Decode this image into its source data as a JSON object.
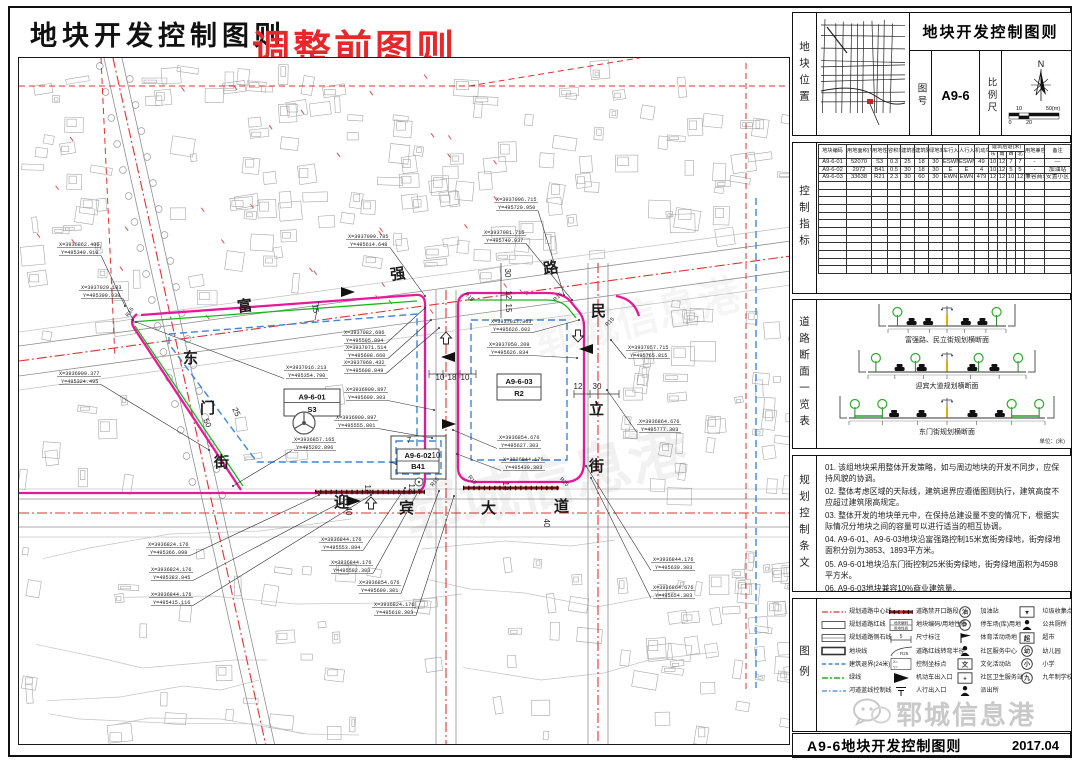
{
  "title": {
    "main": "地块开发控制图则",
    "overlay": "调整前图则"
  },
  "colors": {
    "magenta": "#e8189b",
    "green": "#18b818",
    "blue": "#3f86d8",
    "red": "#e03131",
    "overlay_red": "#e8272a"
  },
  "map": {
    "street_characters": [
      {
        "t": "富",
        "x": 219,
        "y": 254,
        "r": -8
      },
      {
        "t": "强",
        "x": 372,
        "y": 222,
        "r": -8
      },
      {
        "t": "路",
        "x": 525,
        "y": 216,
        "r": -8
      },
      {
        "t": "东",
        "x": 164,
        "y": 305,
        "r": 0
      },
      {
        "t": "门",
        "x": 181,
        "y": 355,
        "r": 0
      },
      {
        "t": "街",
        "x": 195,
        "y": 409,
        "r": 0
      },
      {
        "t": "民",
        "x": 572,
        "y": 258,
        "r": 0
      },
      {
        "t": "立",
        "x": 570,
        "y": 356,
        "r": 0
      },
      {
        "t": "街",
        "x": 570,
        "y": 413,
        "r": 0
      },
      {
        "t": "迎",
        "x": 315,
        "y": 449,
        "r": 0
      },
      {
        "t": "宾",
        "x": 380,
        "y": 455,
        "r": 0
      },
      {
        "t": "大",
        "x": 462,
        "y": 455,
        "r": 0
      },
      {
        "t": "道",
        "x": 535,
        "y": 453,
        "r": 0
      }
    ],
    "parcel_labels": [
      {
        "code": "A9-6-01",
        "use": "S3",
        "x": 265,
        "y": 331,
        "w": 56,
        "h": 27
      },
      {
        "code": "A9-6-02",
        "use": "B41",
        "x": 378,
        "y": 391,
        "w": 42,
        "h": 24
      },
      {
        "code": "A9-6-03",
        "use": "R2",
        "x": 478,
        "y": 316,
        "w": 44,
        "h": 26
      }
    ],
    "coordinate_callouts": [
      {
        "X": "X=3936862.406",
        "Y": "Y=495349.910",
        "lx": 40,
        "ly": 188,
        "ax": 106,
        "ay": 248
      },
      {
        "X": "X=3937029.103",
        "Y": "Y=495399.038",
        "lx": 62,
        "ly": 231,
        "ax": 114,
        "ay": 262
      },
      {
        "X": "X=3936999.377",
        "Y": "Y=495324.495",
        "lx": 40,
        "ly": 317,
        "ax": 190,
        "ay": 392
      },
      {
        "X": "X=3937099.785",
        "Y": "Y=495614.648",
        "lx": 329,
        "ly": 180,
        "ax": 406,
        "ay": 238
      },
      {
        "X": "X=3937082.686",
        "Y": "Y=495595.894",
        "lx": 325,
        "ly": 276,
        "ax": 406,
        "ay": 250
      },
      {
        "X": "X=3937071.514",
        "Y": "Y=495608.660",
        "lx": 327,
        "ly": 291,
        "ax": 412,
        "ay": 262
      },
      {
        "X": "X=3937068.432",
        "Y": "Y=495608.849",
        "lx": 325,
        "ly": 306,
        "ax": 420,
        "ay": 270
      },
      {
        "X": "X=3936900.897",
        "Y": "Y=495609.303",
        "lx": 327,
        "ly": 333,
        "ax": 415,
        "ay": 352
      },
      {
        "X": "X=3936900.897",
        "Y": "Y=495555.801",
        "lx": 317,
        "ly": 361,
        "ax": 413,
        "ay": 380
      },
      {
        "X": "X=3937016.213",
        "Y": "Y=495354.790",
        "lx": 267,
        "ly": 311,
        "ax": 117,
        "ay": 264
      },
      {
        "X": "X=3936857.165",
        "Y": "Y=495292.896",
        "lx": 275,
        "ly": 383,
        "ax": 214,
        "ay": 428
      },
      {
        "X": "X=3937096.715",
        "Y": "Y=495729.950",
        "lx": 477,
        "ly": 143,
        "ax": 545,
        "ay": 237
      },
      {
        "X": "X=3937081.715",
        "Y": "Y=495749.937",
        "lx": 465,
        "ly": 176,
        "ax": 553,
        "ay": 242
      },
      {
        "X": "X=3937017.363",
        "Y": "Y=495626.602",
        "lx": 472,
        "ly": 265,
        "ax": 560,
        "ay": 262
      },
      {
        "X": "X=3937050.209",
        "Y": "Y=495626.834",
        "lx": 470,
        "ly": 288,
        "ax": 558,
        "ay": 300
      },
      {
        "X": "X=3937057.715",
        "Y": "Y=495765.815",
        "lx": 609,
        "ly": 291,
        "ax": 592,
        "ay": 282
      },
      {
        "X": "X=3936864.676",
        "Y": "Y=495777.303",
        "lx": 620,
        "ly": 365,
        "ax": 588,
        "ay": 332
      },
      {
        "X": "X=3936844.176",
        "Y": "Y=495639.303",
        "lx": 634,
        "ly": 503,
        "ax": 567,
        "ay": 408
      },
      {
        "X": "X=3936864.676",
        "Y": "Y=495654.303",
        "lx": 634,
        "ly": 531,
        "ax": 572,
        "ay": 420
      },
      {
        "X": "X=3936824.176",
        "Y": "Y=495366.098",
        "lx": 129,
        "ly": 488,
        "ax": 300,
        "ay": 437
      },
      {
        "X": "X=3936824.176",
        "Y": "Y=495383.945",
        "lx": 132,
        "ly": 513,
        "ax": 330,
        "ay": 440
      },
      {
        "X": "X=3936844.176",
        "Y": "Y=495415.116",
        "lx": 132,
        "ly": 538,
        "ax": 352,
        "ay": 437
      },
      {
        "X": "X=3936844.176",
        "Y": "Y=495553.894",
        "lx": 302,
        "ly": 483,
        "ax": 386,
        "ay": 430
      },
      {
        "X": "X=3936844.176",
        "Y": "Y=495592.303",
        "lx": 312,
        "ly": 506,
        "ax": 400,
        "ay": 432
      },
      {
        "X": "X=3936854.676",
        "Y": "Y=495609.301",
        "lx": 340,
        "ly": 526,
        "ax": 420,
        "ay": 433
      },
      {
        "X": "X=3936824.176",
        "Y": "Y=495618.303",
        "lx": 355,
        "ly": 548,
        "ax": 435,
        "ay": 438
      },
      {
        "X": "X=3936854.676",
        "Y": "Y=495627.303",
        "lx": 480,
        "ly": 381,
        "ax": 434,
        "ay": 372
      },
      {
        "X": "X=3936844.176",
        "Y": "Y=495439.303",
        "lx": 484,
        "ly": 403,
        "ax": 438,
        "ay": 396
      }
    ],
    "dimension_labels": [
      {
        "t": "10",
        "x": 421,
        "y": 322,
        "r": 0
      },
      {
        "t": "18",
        "x": 433,
        "y": 322,
        "r": 0
      },
      {
        "t": "10",
        "x": 446,
        "y": 322,
        "r": 0
      },
      {
        "t": "30",
        "x": 486,
        "y": 215,
        "r": 90
      },
      {
        "t": "12",
        "x": 487,
        "y": 237,
        "r": 90
      },
      {
        "t": "15",
        "x": 487,
        "y": 250,
        "r": 90
      },
      {
        "t": "15",
        "x": 294,
        "y": 251,
        "r": 80
      },
      {
        "t": "25",
        "x": 215,
        "y": 355,
        "r": 65
      },
      {
        "t": "50",
        "x": 186,
        "y": 366,
        "r": 65
      },
      {
        "t": "12",
        "x": 346,
        "y": 431,
        "r": 90
      },
      {
        "t": "40",
        "x": 327,
        "y": 453,
        "r": 90
      },
      {
        "t": "12",
        "x": 484,
        "y": 428,
        "r": 90
      },
      {
        "t": "40",
        "x": 525,
        "y": 465,
        "r": 90
      },
      {
        "t": "12",
        "x": 559,
        "y": 331,
        "r": 0
      },
      {
        "t": "30",
        "x": 578,
        "y": 331,
        "r": 0
      },
      {
        "t": "7",
        "x": 390,
        "y": 385,
        "r": 0
      },
      {
        "t": "7",
        "x": 372,
        "y": 405,
        "r": 90
      },
      {
        "t": "10",
        "x": 417,
        "y": 400,
        "r": 0
      },
      {
        "t": "12",
        "x": 390,
        "y": 430,
        "r": 90
      }
    ],
    "radius_labels": [
      {
        "t": "R15",
        "x": 417,
        "y": 425,
        "r": -50
      },
      {
        "t": "R15",
        "x": 452,
        "y": 423,
        "r": 50
      },
      {
        "t": "R25",
        "x": 544,
        "y": 425,
        "r": 45
      },
      {
        "t": "R15",
        "x": 449,
        "y": 240,
        "r": 45
      },
      {
        "t": "R15",
        "x": 540,
        "y": 240,
        "r": -45
      },
      {
        "t": "R15",
        "x": 112,
        "y": 255,
        "r": -55
      },
      {
        "t": "R15",
        "x": 592,
        "y": 265,
        "r": -45
      }
    ],
    "entrance_markers": [
      {
        "x": 329,
        "y": 234,
        "dir": "r",
        "t": "car"
      },
      {
        "x": 429,
        "y": 299,
        "dir": "l",
        "t": "car"
      },
      {
        "x": 427,
        "y": 281,
        "dir": "u",
        "t": "ped"
      },
      {
        "x": 430,
        "y": 366,
        "dir": "r",
        "t": "car"
      },
      {
        "x": 335,
        "y": 443,
        "dir": "r",
        "t": "car"
      },
      {
        "x": 352,
        "y": 446,
        "dir": "u",
        "t": "ped"
      },
      {
        "x": 567,
        "y": 291,
        "dir": "l",
        "t": "car"
      },
      {
        "x": 559,
        "y": 277,
        "dir": "d",
        "t": "ped"
      }
    ],
    "watermark": "郓城信息港"
  },
  "sidebar": {
    "location": {
      "label": "地块位置",
      "block_title": "地块开发控制图则",
      "sheet_no_label": "图号",
      "sheet_no": "A9-6",
      "scale_label": "比例尺",
      "north": "N",
      "scale_top": [
        "10",
        "50(m)"
      ],
      "scale_bottom": [
        "0",
        "20"
      ]
    },
    "indicators": {
      "label": "控制指标",
      "headers": [
        "地块编码",
        "用地面积(平方米)",
        "用地性质",
        "容积率",
        "建筑密度(%)",
        "建筑限高(米)",
        "绿地率(%)",
        "车行入口方向",
        "人行入口方向",
        "机动车位(个)",
        "建筑后退(米)",
        "用地兼容",
        "备注"
      ],
      "setback_sub": [
        "东",
        "南",
        "西",
        "北"
      ],
      "rows": [
        [
          "A9-6-01",
          "52070",
          "S3",
          "0.3",
          "25",
          "18",
          "30",
          "ESWN",
          "ESWN",
          "49",
          "10",
          "12",
          "7",
          "7",
          "-",
          "—"
        ],
        [
          "A9-6-02",
          "2972",
          "B41",
          "0.5",
          "30",
          "18",
          "30",
          "E",
          "E",
          "4",
          "10",
          "12",
          "5",
          "5",
          "-",
          "加油站"
        ],
        [
          "A9-6-03",
          "33638",
          "R21",
          "2.3",
          "30",
          "60",
          "30",
          "EWN",
          "EWN",
          "479",
          "12",
          "12",
          "10",
          "12",
          "兼容商业",
          "安置小区"
        ]
      ],
      "empty_rows": 12
    },
    "road_sections": {
      "label": "道路断面一览表",
      "items": [
        "富强路、民立街规划横断面",
        "迎宾大道规划横断面",
        "东门街规划横断面"
      ],
      "unit": "单位：(米)"
    },
    "provisions": {
      "label": "规划控制条文",
      "items": [
        "01. 该组地块采用整体开发策略，如与周边地块的开发不同步，应保持风貌的协调。",
        "02. 整体考虑区域的天际线，建筑退界应遵循图则执行，建筑高度不应超过建筑限高规定。",
        "03. 整体开发的地块单元中，在保持总建设量不变的情况下，根据实际情况分地块之间的容量可以进行适当的相互协调。",
        "04. A9-6-01、A9-6-03地块沿富强路控制15米宽街旁绿地，街旁绿地面积分别为3853、1893平方米。",
        "05. A9-6-01地块沿东门街控制25米街旁绿地，街旁绿地面积为4598平方米。",
        "06. A9-6-03地块兼容10%商业建筑量。"
      ]
    },
    "legend": {
      "label": "图例",
      "columns": [
        [
          {
            "type": "centerline",
            "label": "规划道路中心线"
          },
          {
            "type": "redline",
            "label": "规划道路红线"
          },
          {
            "type": "sidestone",
            "label": "规划道路侧石线"
          },
          {
            "type": "parcelline",
            "label": "地块线"
          },
          {
            "type": "setback",
            "label": "建筑退界(24米)"
          },
          {
            "type": "greenline",
            "label": "绿线"
          },
          {
            "type": "riverline",
            "label": "河道蓝线控制线"
          }
        ],
        [
          {
            "type": "noopen",
            "label": "道路禁开口路段"
          },
          {
            "type": "codebox",
            "label": "地块编码/用地性质",
            "g1": "地块编码",
            "g2": "用地性质"
          },
          {
            "type": "dimnote",
            "label": "尺寸标注",
            "glyph": "5"
          },
          {
            "type": "turnradius",
            "label": "道路红线转弯半径",
            "glyph": "R25"
          },
          {
            "type": "coordpoint",
            "label": "控制坐标点",
            "g1": "X=",
            "g2": "Y="
          },
          {
            "type": "cartri",
            "label": "机动车出入口"
          },
          {
            "type": "pedarrow",
            "label": "人行出入口"
          }
        ],
        [
          {
            "type": "circleglyph",
            "glyph": "油",
            "label": "加油站"
          },
          {
            "type": "circleglyph",
            "glyph": "P",
            "label": "停车场(库)用地"
          },
          {
            "type": "flag",
            "label": "体育活动场地"
          },
          {
            "type": "person",
            "label": "社区服务中心"
          },
          {
            "type": "boxglyph",
            "glyph": "文",
            "label": "文化活动站"
          },
          {
            "type": "boxglyph",
            "glyph": "+",
            "label": "社区卫生服务站"
          },
          {
            "type": "person",
            "label": "派出所"
          }
        ],
        [
          {
            "type": "boxglyph",
            "glyph": "▼",
            "label": "垃圾收集点"
          },
          {
            "type": "person",
            "label": "公共厕所"
          },
          {
            "type": "boxglyph",
            "glyph": "超",
            "label": "超市"
          },
          {
            "type": "circleglyph",
            "glyph": "幼",
            "label": "幼儿园"
          },
          {
            "type": "circleglyph",
            "glyph": "小",
            "label": "小学"
          },
          {
            "type": "circleglyph",
            "glyph": "九",
            "label": "九年制学校"
          }
        ]
      ]
    },
    "footer": {
      "title": "A9-6地块开发控制图则",
      "date": "2017.04"
    },
    "watermark": "郓城信息港"
  }
}
